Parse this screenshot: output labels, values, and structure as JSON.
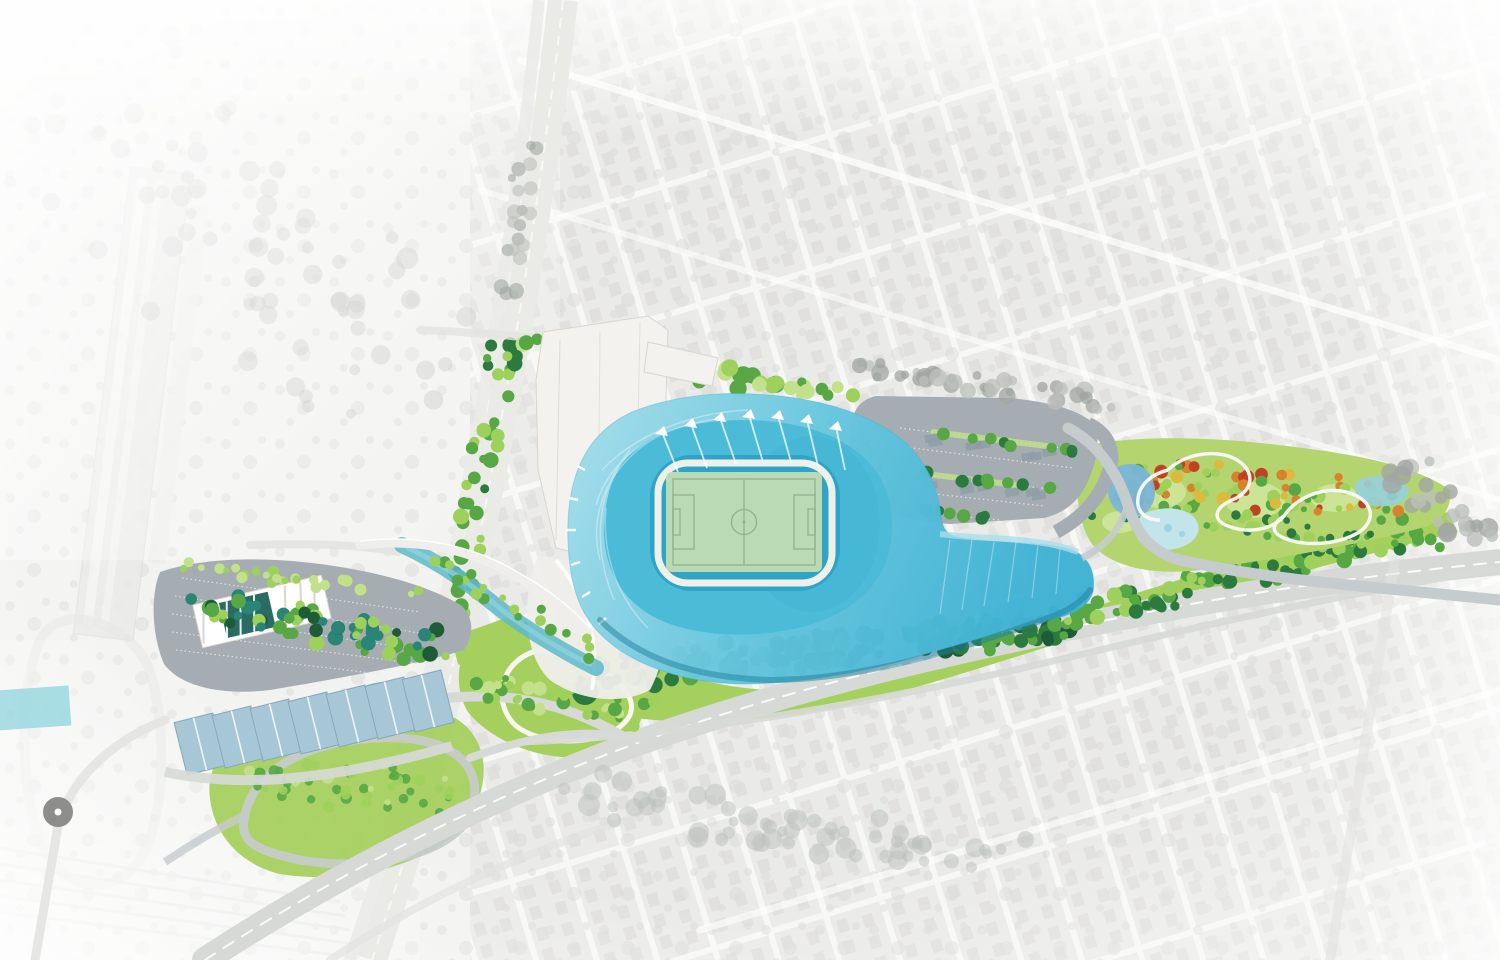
{
  "scene": {
    "kind": "aerial-site-plan-rendering",
    "visible_text": []
  },
  "palette": {
    "bg": "#f7f7f5",
    "leftBase": "#f2f2f0",
    "blockFill": "#e9e9e7",
    "houseFill": "#dedddb",
    "speck": "#dadbd8",
    "corridor": "#eaeae7",
    "corridorLine": "#f8f8f6",
    "roadLight": "#d7d9d7",
    "roadMid": "#c6cbcd",
    "roadFaded": "#e3e3e1",
    "asphalt": "#a6adb2",
    "stallLine": "#dfe3e4",
    "carShadow": "#8e9da7",
    "path": "#fafaf8",
    "lawn": "#a6d05e",
    "lawnLight": "#c3e08a",
    "parkLawn": "#b3d46e",
    "parkPatch": "#cbe496",
    "treeBright": "#9ed05c",
    "treeMid": "#57a844",
    "treeDark": "#2b7a3e",
    "treeDeep": "#1e5c38",
    "treeTeal": "#2a8577",
    "treeGray": "#bcbfbb",
    "treeGrayDark": "#a2a6a2",
    "fallOrange": "#d9822d",
    "fallRed": "#bf4323",
    "fallYellow": "#ddb93e",
    "roofLight": "#a8dfeb",
    "roofMid": "#66c6de",
    "roofDeep": "#3fb2d4",
    "bowlMid": "#4cbbd8",
    "bowlInner": "#2ea4c8",
    "shadowTeal": "#1f7f9b",
    "concourse": "#f0f0ea",
    "pitch": "#b9dab3",
    "pitchLine": "#8fb28c",
    "bldgWhite": "#f3f2ee",
    "bldgEdge": "#d9d6cf",
    "plaza": "#efeeea",
    "blueRoof": "#a8c7d6",
    "blueRoofEdge": "#85a8ba",
    "canal": "#5fb9c9",
    "canalHi": "#8fd4de",
    "pond": "#93d0e0",
    "pondDeep": "#7ab5d8",
    "pondLight": "#c2e5ec",
    "canopyDark": "#2a6b63",
    "roundabout": "#8d8d8b",
    "white": "#ffffff"
  }
}
